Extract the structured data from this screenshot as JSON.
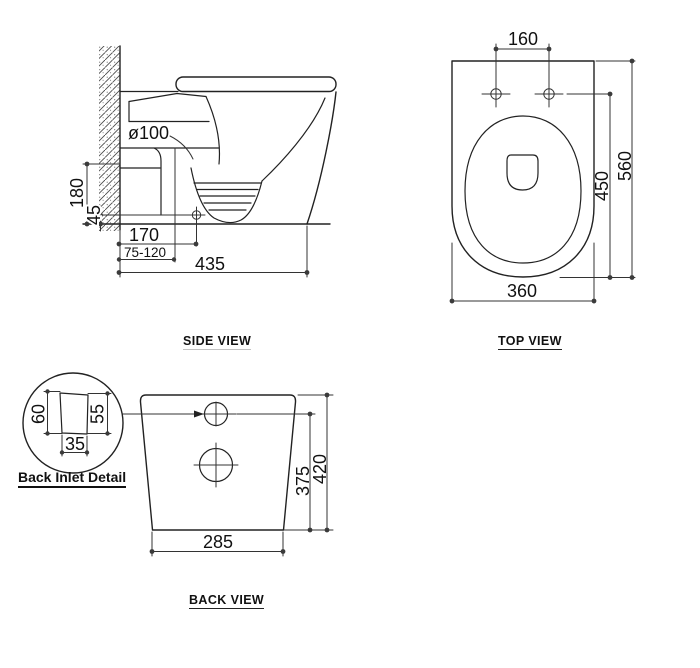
{
  "drawing": {
    "background": "#ffffff",
    "line_color": "#222222",
    "product": "wall-faced toilet pan dimension drawing"
  },
  "side_view": {
    "label": "SIDE VIEW",
    "dims": {
      "outlet_dia": "ø100",
      "inlet_height": "180",
      "outlet_center_height": "45",
      "outlet_setout": "170",
      "setout_range": "75-120",
      "depth": "435"
    }
  },
  "top_view": {
    "label": "TOP VIEW",
    "dims": {
      "hole_spacing": "160",
      "bowl_length": "450",
      "overall_depth": "560",
      "width": "360"
    }
  },
  "back_view": {
    "label": "BACK VIEW",
    "dims": {
      "inlet_height": "375",
      "overall_height": "420",
      "base_width": "285"
    }
  },
  "inlet_detail": {
    "label": "Back Inlet Detail",
    "dims": {
      "outer_height": "60",
      "inner_height": "55",
      "width": "35"
    }
  }
}
